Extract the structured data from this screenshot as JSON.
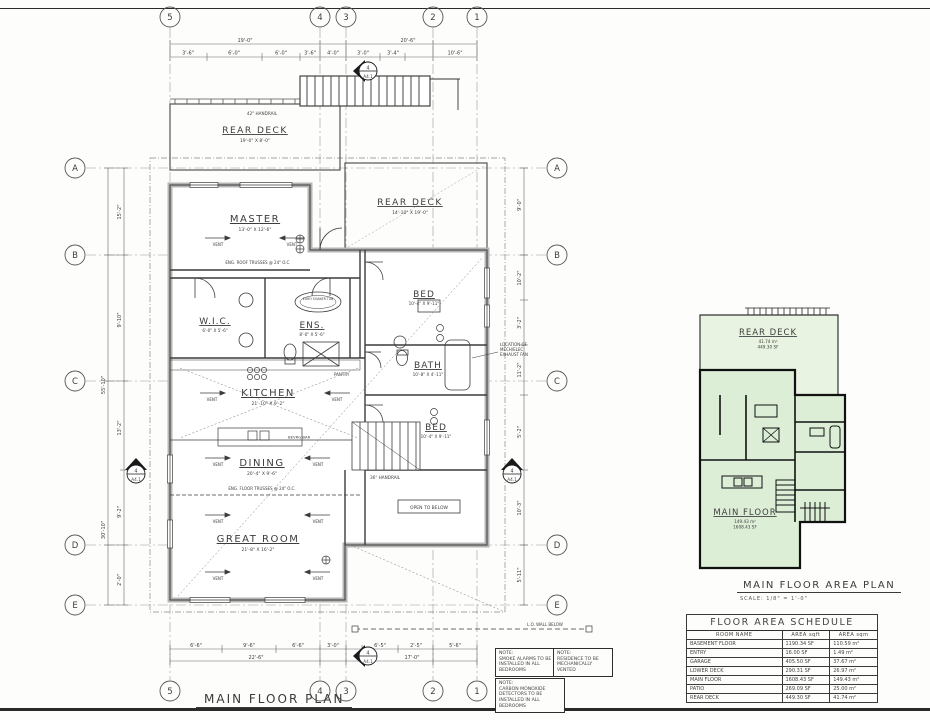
{
  "sheet": {
    "plan_title": "MAIN FLOOR PLAN",
    "area_plan_title": "MAIN FLOOR AREA PLAN",
    "area_plan_scale": "SCALE:   1/8\" = 1'-0\""
  },
  "grid": {
    "cols": [
      "5",
      "4",
      "3",
      "2",
      "1"
    ],
    "rows": [
      "A",
      "B",
      "C",
      "D",
      "E"
    ]
  },
  "rooms": {
    "master": {
      "name": "MASTER",
      "dims": "13'-0\" X 12'-6\""
    },
    "wic": {
      "name": "W.I.C.",
      "dims": "6'-0\" X 5'-6\""
    },
    "ens": {
      "name": "ENS.",
      "dims": "8'-0\" X 5'-6\""
    },
    "kitchen": {
      "name": "KITCHEN",
      "dims": "21'-10\" X 9'-2\""
    },
    "dining": {
      "name": "DINING",
      "dims": "20'-4\" X 9'-6\""
    },
    "great": {
      "name": "GREAT ROOM",
      "dims": "21'-8\" X 16'-2\""
    },
    "bed1": {
      "name": "BED",
      "dims": "10'-4\" X 9'-11\""
    },
    "bath": {
      "name": "BATH",
      "dims": "10'-8\" X 4'-11\""
    },
    "bed2": {
      "name": "BED",
      "dims": "10'-4\" X 9'-11\""
    },
    "deck_left": {
      "name": "REAR DECK",
      "dims": "19'-0\" X 8'-0\""
    },
    "deck_right": {
      "name": "REAR DECK",
      "dims": "14'-10\" X 19'-0\""
    }
  },
  "labels": {
    "vent": "VENT",
    "open_below": "OPEN TO BELOW",
    "handrail36": "36\" HANDRAIL",
    "handrail42": "42\" HANDRAIL",
    "lo_wall": "L.O. WALL BELOW",
    "pantry": "PANTRY",
    "bevrg": "BEVRG BAR",
    "soaker": "EURO SOAKER TUB",
    "exhaust_1": "LOCATION OF",
    "exhaust_2": "MECH/ELEC",
    "exhaust_3": "EXHAUST FAN",
    "trusses_roof": "ENG. ROOF TRUSSES @ 24\" O.C.",
    "trusses_floor": "ENG. FLOOR TRUSSES @ 24\" O.C."
  },
  "marker": {
    "num": "4",
    "sheet": "A4.1"
  },
  "dims": {
    "top_spans": [
      "19'-0\"",
      "20'-6\""
    ],
    "top_segs": [
      "3'-6\"",
      "6'-0\"",
      "6'-0\"",
      "3'-6\"",
      "4'-0\"",
      "3'-0\"",
      "3'-4\"",
      "10'-6\""
    ],
    "bottom_segs": [
      "6'-6\"",
      "9'-6\"",
      "6'-6\"",
      "3'-0\"",
      "6'-5\"",
      "2'-5\"",
      "5'-6\""
    ],
    "bottom_spans": [
      "22'-6\"",
      "17'-0\""
    ],
    "left_segs": [
      "15'-2\"",
      "9'-10\"",
      "13'-2\"",
      "9'-2\"",
      "2'-0\""
    ],
    "left_spans": [
      "55'-10\"",
      "30'-10\""
    ],
    "right_segs": [
      "9'-0\"",
      "10'-2\"",
      "3'-2\"",
      "11'-2\"",
      "5'-2\"",
      "10'-3\"",
      "5'-11\""
    ]
  },
  "notes": [
    {
      "head": "NOTE:",
      "body": "SMOKE ALARMS TO BE INSTALLED IN ALL BEDROOMS"
    },
    {
      "head": "NOTE:",
      "body": "RESIDENCE TO BE MECHANICALLY VENTED"
    },
    {
      "head": "NOTE:",
      "body": "CARBON MONOXIDE DETECTORS TO BE INSTALLED IN ALL BEDROOMS"
    }
  ],
  "area_plan": {
    "deck_label": "REAR DECK",
    "deck_m2": "41.74 m²",
    "deck_sf": "449.30 SF",
    "floor_label": "MAIN FLOOR",
    "floor_m2": "149.43 m²",
    "floor_sf": "1608.43 SF",
    "fill_floor": "#ddeed7",
    "fill_deck": "#e8f3e1"
  },
  "schedule": {
    "title": "FLOOR AREA SCHEDULE",
    "headers": [
      "ROOM NAME",
      "AREA sqft",
      "AREA sqm"
    ],
    "rows": [
      {
        "name": "BASEMENT FLOOR",
        "sqft": "1190.34 SF",
        "sqm": "110.59 m²"
      },
      {
        "name": "ENTRY",
        "sqft": "16.00 SF",
        "sqm": "1.49 m²"
      },
      {
        "name": "GARAGE",
        "sqft": "405.50 SF",
        "sqm": "37.67 m²"
      },
      {
        "name": "LOWER DECK",
        "sqft": "290.31 SF",
        "sqm": "26.97 m²"
      },
      {
        "name": "MAIN FLOOR",
        "sqft": "1608.43 SF",
        "sqm": "149.43 m²"
      },
      {
        "name": "PATIO",
        "sqft": "269.09 SF",
        "sqm": "25.00 m²"
      },
      {
        "name": "REAR DECK",
        "sqft": "449.30 SF",
        "sqm": "41.74 m²"
      }
    ]
  }
}
